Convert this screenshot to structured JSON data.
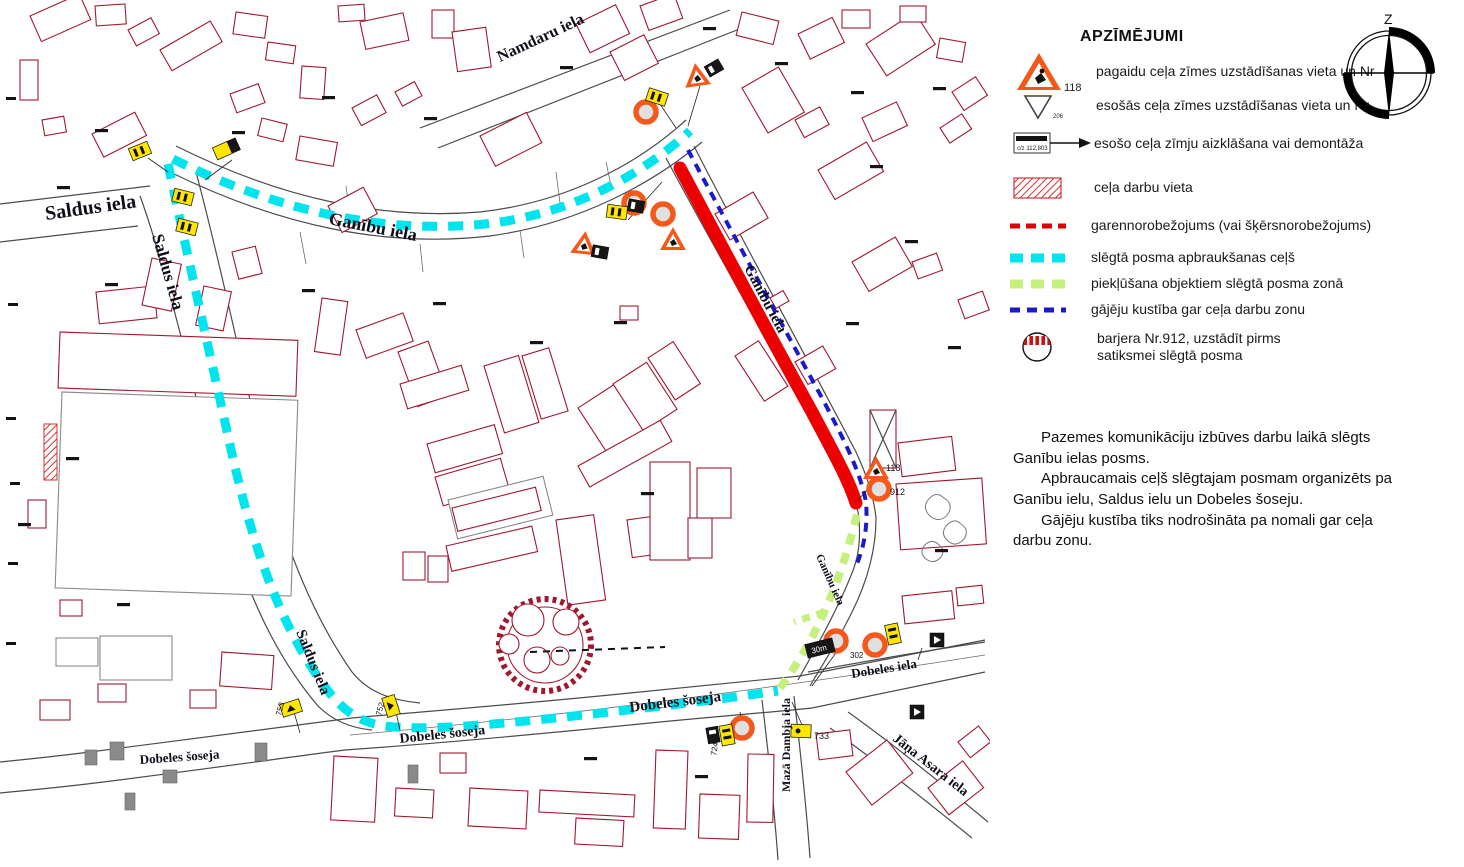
{
  "legend": {
    "title": "APZĪMĒJUMI",
    "items": {
      "temp_sign": {
        "number": "118",
        "label": "pagaidu ceļa zīmes uzstādīšanas vieta un Nr"
      },
      "existing_sign": {
        "number": "206",
        "label": "esošās ceļa zīmes uzstādīšanas vieta un Nr"
      },
      "sign_cover": {
        "plate_text": "c/z 112,803",
        "label": "esošo ceļa zīmju aizklāšana vai demontāža"
      },
      "work_area": {
        "label": "ceļa darbu vieta"
      },
      "longitudinal": {
        "label": "garennorobežojums (vai šķērsnorobežojums)"
      },
      "detour": {
        "label": "slēgtā posma apbraukšanas ceļš"
      },
      "access": {
        "label": "piekļūšana objektiem slēgtā posma zonā"
      },
      "pedestrian": {
        "label": "gājēju kustība gar ceļa darbu zonu"
      },
      "barrier": {
        "label_line1": "barjera Nr.912, uzstādīt pirms",
        "label_line2": "satiksmei slēgtā posma"
      }
    }
  },
  "compass": {
    "north_label": "Z"
  },
  "notes": {
    "p1": "Pazemes komunikāciju izbūves darbu laikā slēgts Ganību ielas posms.",
    "p2": "Apbraucamais ceļš slēgtajam posmam organizēts pa Ganību ielu, Saldus ielu un Dobeles šoseju.",
    "p3": "Gājēju kustība tiks nodrošināta pa nomali gar ceļa darbu zonu."
  },
  "map": {
    "streets": {
      "saldus_h": "Saldus iela",
      "saldus_v": "Saldus iela",
      "saldus_v2": "Saldus iela",
      "ganibu_h": "Ganību iela",
      "ganibu_closed": "Ganību iela",
      "ganibu_s": "Ganību iela",
      "namdaru": "Namdaru iela",
      "dobeles_soseja_1": "Dobeles šoseja",
      "dobeles_soseja_2": "Dobeles šoseja",
      "dobeles_soseja_3": "Dobeles šoseja",
      "dobeles_iela": "Dobeles iela",
      "maza_dambja": "Mazā Dambja iela",
      "jana_asara": "Jāņa Asara iela"
    },
    "sign_labels": {
      "s118": "118",
      "s912": "912",
      "s302": "302",
      "s733": "733",
      "s753": "753",
      "s752": "752",
      "s724": "724",
      "s30m": "30m"
    }
  },
  "colors": {
    "detour": "#00E4EE",
    "access": "#C6F07D",
    "pedestrian": "#1A1ACB",
    "closure": "#ED0000",
    "sign_orange": "#F4591C",
    "building": "#A01830"
  }
}
